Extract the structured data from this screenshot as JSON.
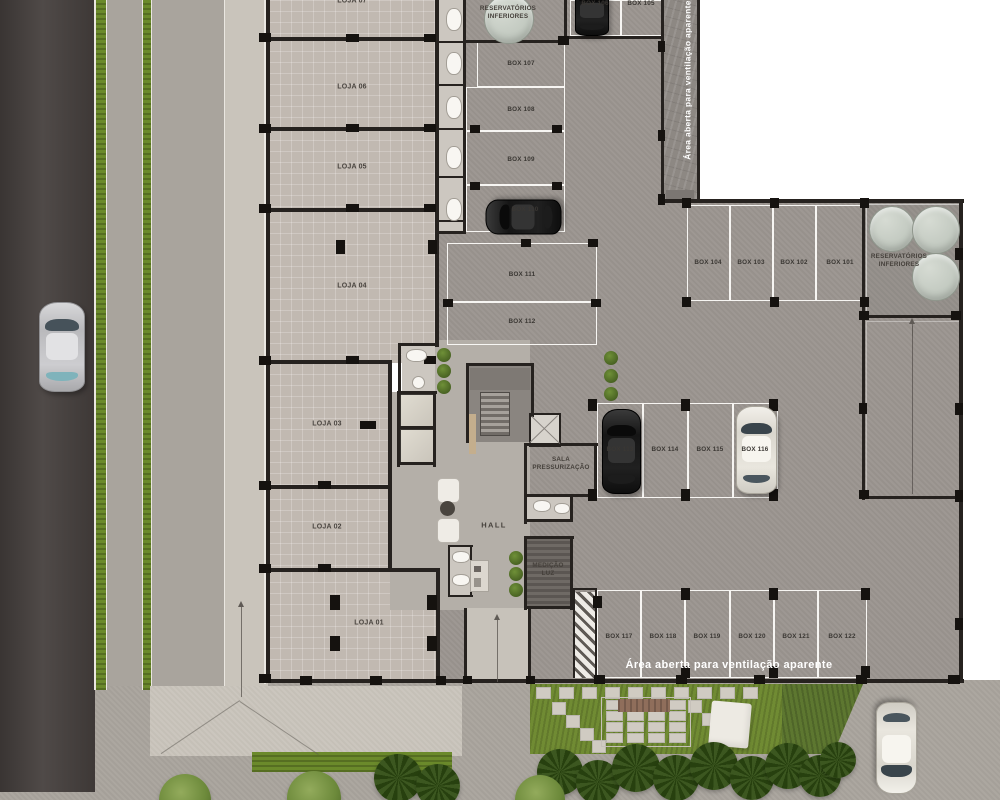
{
  "labels": {
    "hall": "HALL",
    "sala_pressurizacao": "SALA\nPRESSURIZAÇÃO",
    "medicao_luz": "MEDIÇÃO\nLUZ",
    "reservatorios": "RESERVATÓRIOS\nINFERIORES",
    "ventilacao": "Área aberta para ventilação aparente"
  },
  "lojas": [
    {
      "label": "LOJA 07"
    },
    {
      "label": "LOJA 06"
    },
    {
      "label": "LOJA 05"
    },
    {
      "label": "LOJA 04"
    },
    {
      "label": "LOJA 03"
    },
    {
      "label": "LOJA 02"
    },
    {
      "label": "LOJA 01"
    }
  ],
  "boxes": [
    {
      "label": "BOX 105"
    },
    {
      "label": "BOX 106"
    },
    {
      "label": "BOX 107"
    },
    {
      "label": "BOX 108"
    },
    {
      "label": "BOX 109"
    },
    {
      "label": "BOX 110"
    },
    {
      "label": "BOX 111"
    },
    {
      "label": "BOX 112"
    },
    {
      "label": "BOX 101"
    },
    {
      "label": "BOX 102"
    },
    {
      "label": "BOX 103"
    },
    {
      "label": "BOX 104"
    },
    {
      "label": "BOX 113"
    },
    {
      "label": "BOX 114"
    },
    {
      "label": "BOX 115"
    },
    {
      "label": "BOX 116"
    },
    {
      "label": "BOX 117"
    },
    {
      "label": "BOX 118"
    },
    {
      "label": "BOX 119"
    },
    {
      "label": "BOX 120"
    },
    {
      "label": "BOX 121"
    },
    {
      "label": "BOX 122"
    }
  ],
  "cars": [
    {
      "color": "silver",
      "location": "street"
    },
    {
      "color": "black",
      "location": "BOX 106"
    },
    {
      "color": "black",
      "location": "BOX 110"
    },
    {
      "color": "black",
      "location": "BOX 113"
    },
    {
      "color": "white",
      "location": "BOX 116"
    },
    {
      "color": "white",
      "location": "driveway"
    }
  ],
  "colors": {
    "road": "#46403e",
    "pavement": "#a9a49d",
    "loja_floor": "#c1b9b1",
    "garage_floor": "#9c9691",
    "grass": "#6b8a2b",
    "wall": "#26221f",
    "tank": "#c3cac1",
    "label_text": "#45403b",
    "ventilation_text": "#ffffff"
  }
}
